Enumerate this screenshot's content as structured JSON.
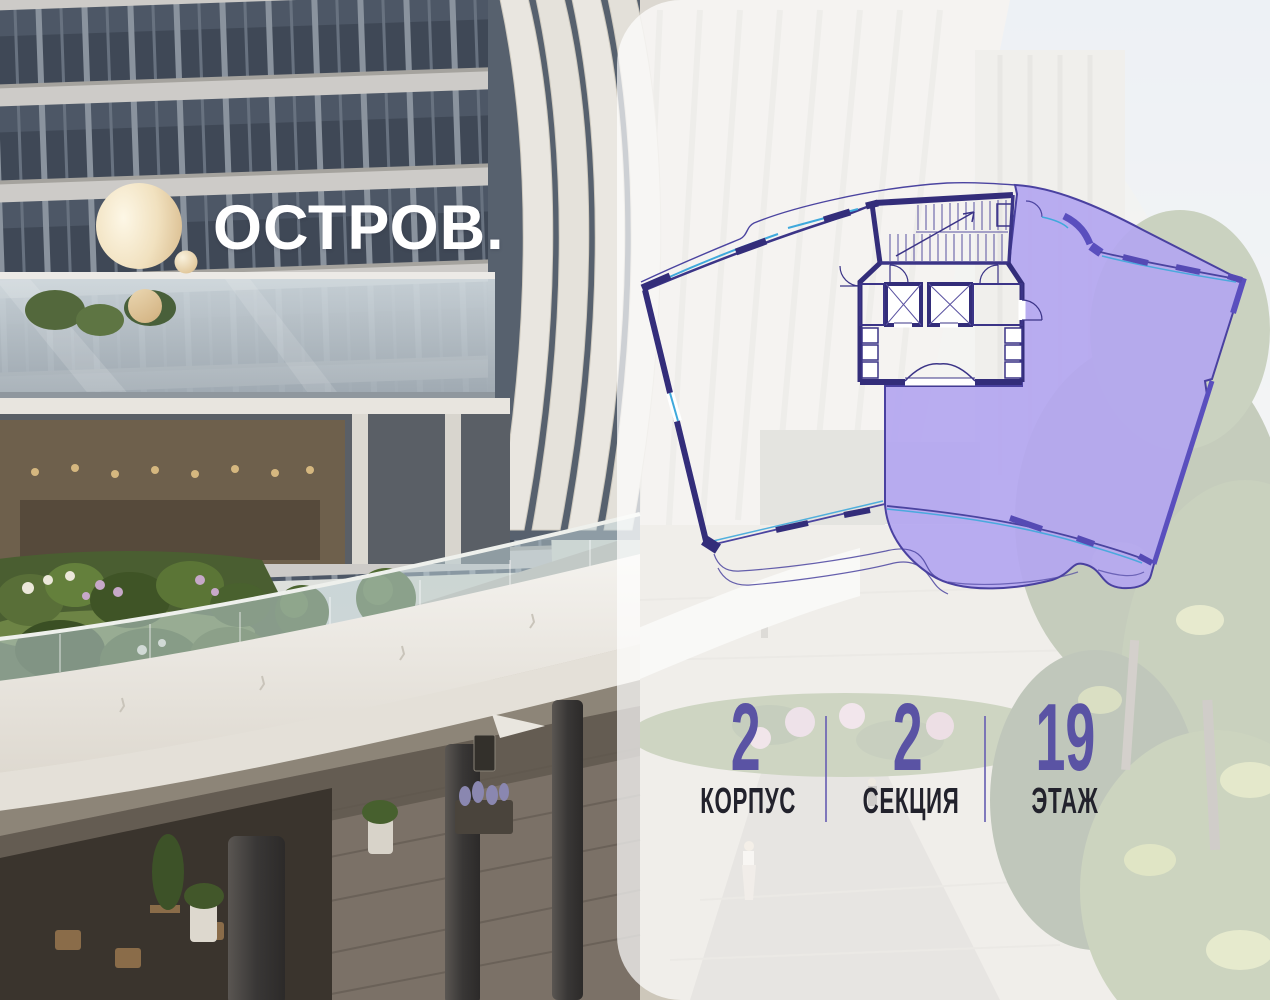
{
  "brand": {
    "logo_text": "ОСТРОВ.",
    "logo_mark": "gold-ring-with-dot",
    "gold_color": "#d9bc8e",
    "text_color": "#ffffff"
  },
  "panel": {
    "background": "rgba(255,255,255,0.70)",
    "corner_radius_px": 64
  },
  "floor_plan": {
    "description": "fan-shaped floor plan, right wing apartment selected",
    "selected_wing": "right",
    "selected_fill": "#b3a6f0",
    "wall_color": "#332d7a",
    "window_color": "#3fa9dc",
    "selected_wall_color": "#5a4fbe"
  },
  "stats": {
    "value_color": "#5a53a4",
    "label_color": "#22222c",
    "divider_color": "#6c64b4",
    "items": [
      {
        "value": "2",
        "label": "КОРПУС"
      },
      {
        "value": "2",
        "label": "СЕКЦИЯ"
      },
      {
        "value": "19",
        "label": "ЭТАЖ"
      }
    ]
  }
}
